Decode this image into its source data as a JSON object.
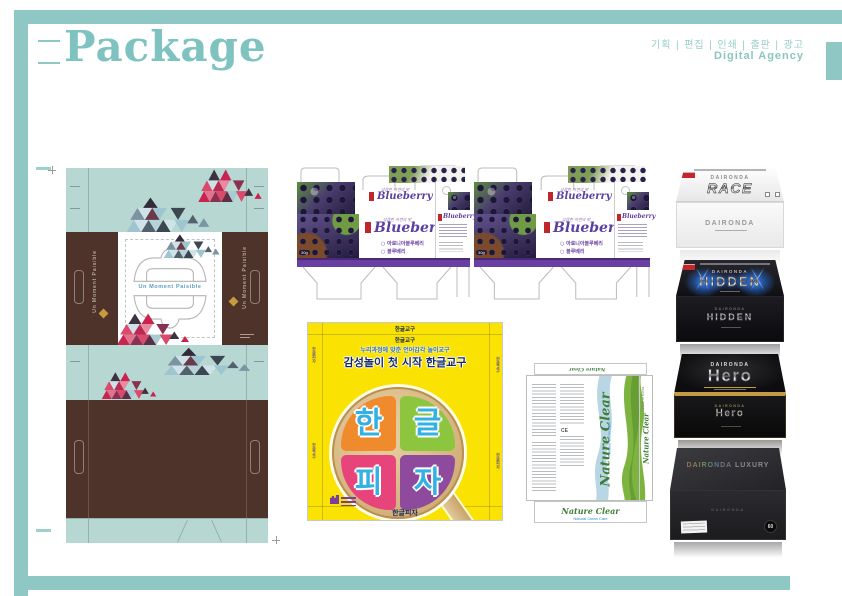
{
  "page": {
    "title": "Package",
    "services": "기획 | 편집 | 인쇄 | 출판 | 광고",
    "agency": "Digital Agency",
    "accent_color": "#8fc7c4"
  },
  "moment_box": {
    "brand": "Un Moment Paisible",
    "colors": {
      "mint": "#b7d7d3",
      "brown": "#4e332a"
    }
  },
  "blueberry": {
    "name": "Blueberry",
    "tagline": "상큼한 자연의 맛",
    "variants": [
      "아로니아블루베리",
      "블루베리"
    ],
    "weight": "30g",
    "band_color": "#6a3fa2",
    "script_color": "#5b3fa0"
  },
  "pizza": {
    "header_small": "한글교구",
    "line1": "누리과정에 맞춘 언어감각 놀이교구",
    "line2": "감성놀이 첫 시작 한글교구",
    "slices": [
      {
        "char": "한",
        "color": "#ef8b2c"
      },
      {
        "char": "글",
        "color": "#8cc63e"
      },
      {
        "char": "피",
        "color": "#e8447c"
      },
      {
        "char": "자",
        "color": "#8e4a9d"
      }
    ],
    "bottom_text": "한글피자",
    "bg_color": "#fae303"
  },
  "nature_clear": {
    "brand": "Nature Clear",
    "subtext": "Natural Clean Care",
    "made_in": "Made in Korea",
    "ce_mark": "CE",
    "brand_color": "#3f7d38"
  },
  "boxes": {
    "brand": "DAIRONDA",
    "items": [
      {
        "name": "RACE",
        "style": "white"
      },
      {
        "name": "HIDDEN",
        "style": "black-blue"
      },
      {
        "name": "Hero",
        "style": "black-gold"
      },
      {
        "name": "LUXURY",
        "style": "charcoal",
        "badge": "60"
      }
    ]
  }
}
